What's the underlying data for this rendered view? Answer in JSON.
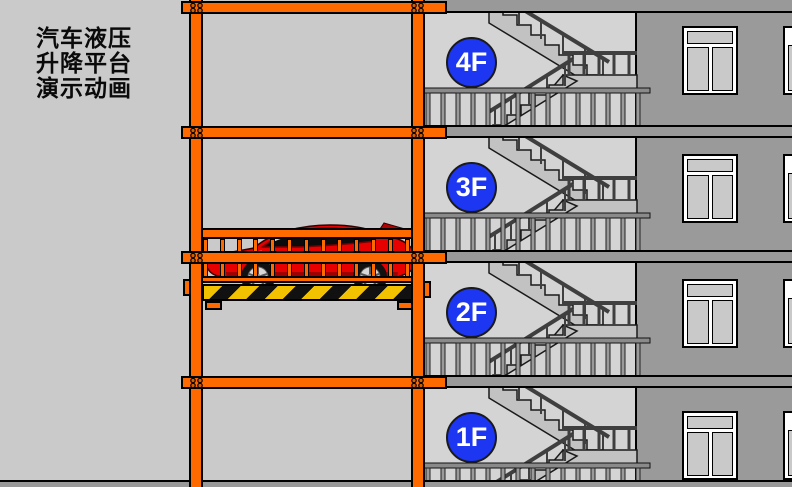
{
  "title": {
    "lines": [
      "汽车液压",
      "升降平台",
      "演示动画"
    ]
  },
  "floors": [
    {
      "label": "4F"
    },
    {
      "label": "3F"
    },
    {
      "label": "2F"
    },
    {
      "label": "1F"
    }
  ],
  "platform": {
    "cargo": "red sports car"
  },
  "colors": {
    "background": "#cacaca",
    "stairwell": "#d4d4d4",
    "wall": "#9a9a9a",
    "slab": "#999999",
    "frame_orange": "#ff6a00",
    "label_blue": "#1c36f2",
    "hazard_yellow": "#f2c200",
    "hazard_black": "#111111",
    "car_red": "#e60000"
  }
}
